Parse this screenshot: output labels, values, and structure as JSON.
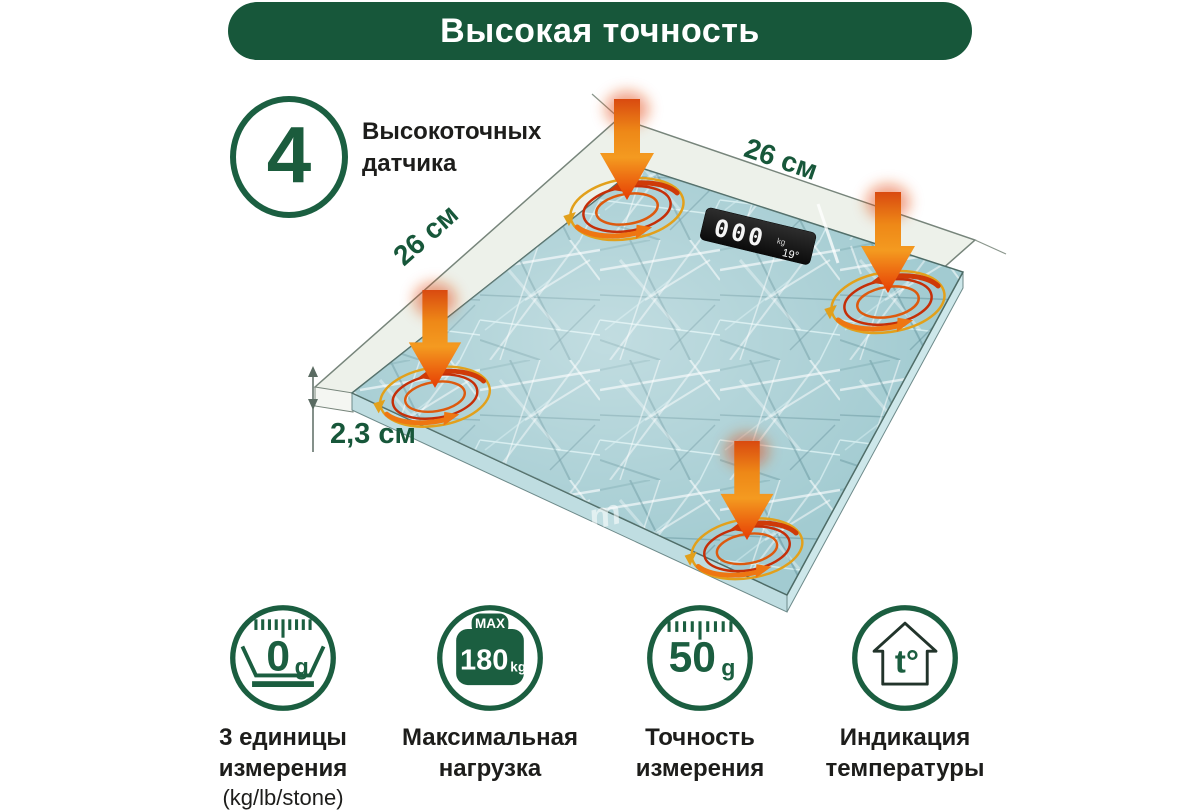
{
  "banner": {
    "title": "Высокая точность"
  },
  "sensors_feature": {
    "count": "4",
    "label_line1": "Высокоточных",
    "label_line2": "датчика"
  },
  "dimensions": {
    "width_top": "26 см",
    "width_left": "26 см",
    "height": "2,3 см"
  },
  "display": {
    "weight": "000",
    "unit": "kg",
    "temperature": "19°"
  },
  "watermark_letter": "m",
  "features": [
    {
      "icon": "units-dial-icon",
      "icon_value": "0",
      "icon_value_unit": "g",
      "caption_line1": "3 единицы",
      "caption_line2": "измерения",
      "caption_line3": "(kg/lb/stone)"
    },
    {
      "icon": "max-weight-icon",
      "icon_top": "MAX",
      "icon_value": "180",
      "icon_value_unit": "kg",
      "caption_line1": "Максимальная",
      "caption_line2": "нагрузка"
    },
    {
      "icon": "ruler-precision-icon",
      "icon_value": "50",
      "icon_value_unit": "g",
      "caption_line1": "Точность",
      "caption_line2": "измерения"
    },
    {
      "icon": "house-temperature-icon",
      "icon_value": "t°",
      "caption_line1": "Индикация",
      "caption_line2": "температуры"
    }
  ],
  "colors": {
    "brand_green": "#17573a",
    "text_dark": "#1d1d1b",
    "arrow_orange": "#f08c1e",
    "arrow_red": "#e63a04",
    "glass_teal": "#a2cbd1"
  }
}
